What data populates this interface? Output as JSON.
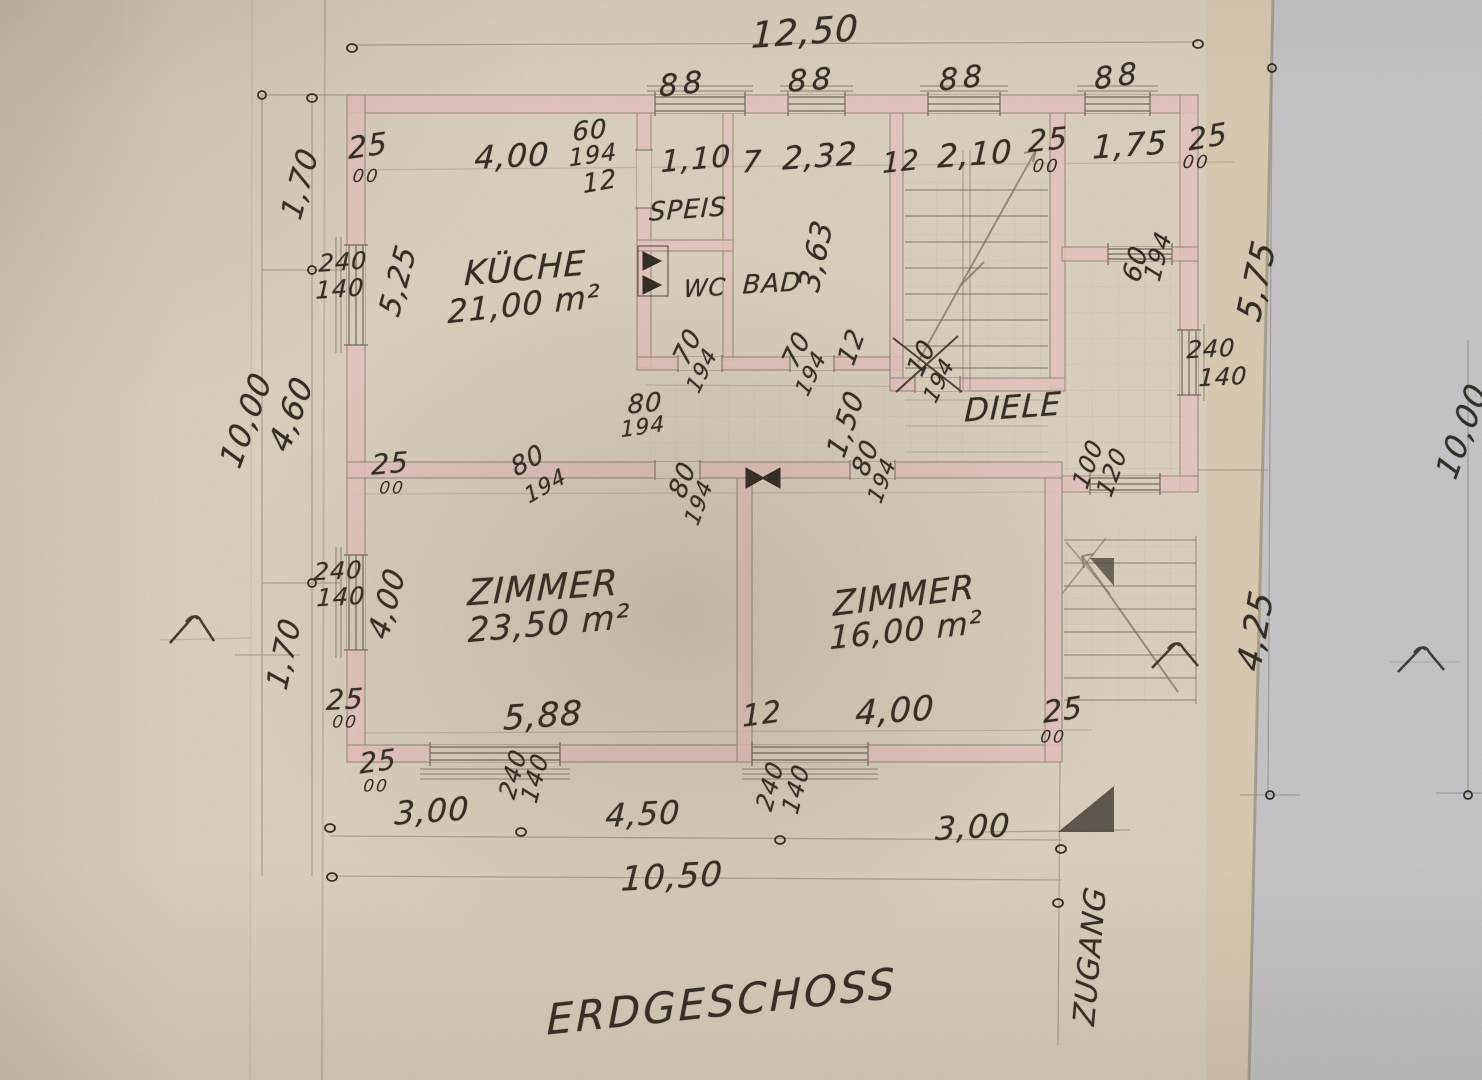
{
  "sheet": {
    "title": "ERDGESCHOSS",
    "paper_color": "#dcd3c2",
    "underlay_color": "#c7c6c9",
    "wall_color": "#e9c3c3",
    "ink_color": "#2b2620",
    "pencil_color": "#8a8072"
  },
  "rooms": {
    "kueche": {
      "name": "KÜCHE",
      "area": "21,00 m²"
    },
    "speis": {
      "name": "SPEIS"
    },
    "wc": {
      "name": "WC"
    },
    "bad": {
      "name": "BAD"
    },
    "diele": {
      "name": "DIELE"
    },
    "zimmer_sw": {
      "name": "ZIMMER",
      "area": "23,50 m²"
    },
    "zimmer_se": {
      "name": "ZIMMER",
      "area": "16,00 m²"
    },
    "zugang": {
      "name": "ZUGANG"
    }
  },
  "dims": {
    "d1250": "12,50",
    "d1050": "10,50",
    "d1000": "10,00",
    "d588": "5,88",
    "d575": "5,75",
    "d525": "5,25",
    "d460": "4,60",
    "d450": "4,50",
    "d425": "4,25",
    "d400": "4,00",
    "d363": "3,63",
    "d300": "3,00",
    "d232": "2,32",
    "d210": "2,10",
    "d175": "1,75",
    "d170": "1,70",
    "d150": "1,50",
    "d110": "1,10",
    "d25": "25",
    "d12": "12",
    "d10": "10",
    "d7": "7",
    "doo": "00",
    "d60": "60",
    "d70": "70",
    "d80": "80",
    "d100": "100",
    "d120": "120",
    "d140": "140",
    "d194": "194",
    "d240": "240",
    "d88": "88"
  }
}
